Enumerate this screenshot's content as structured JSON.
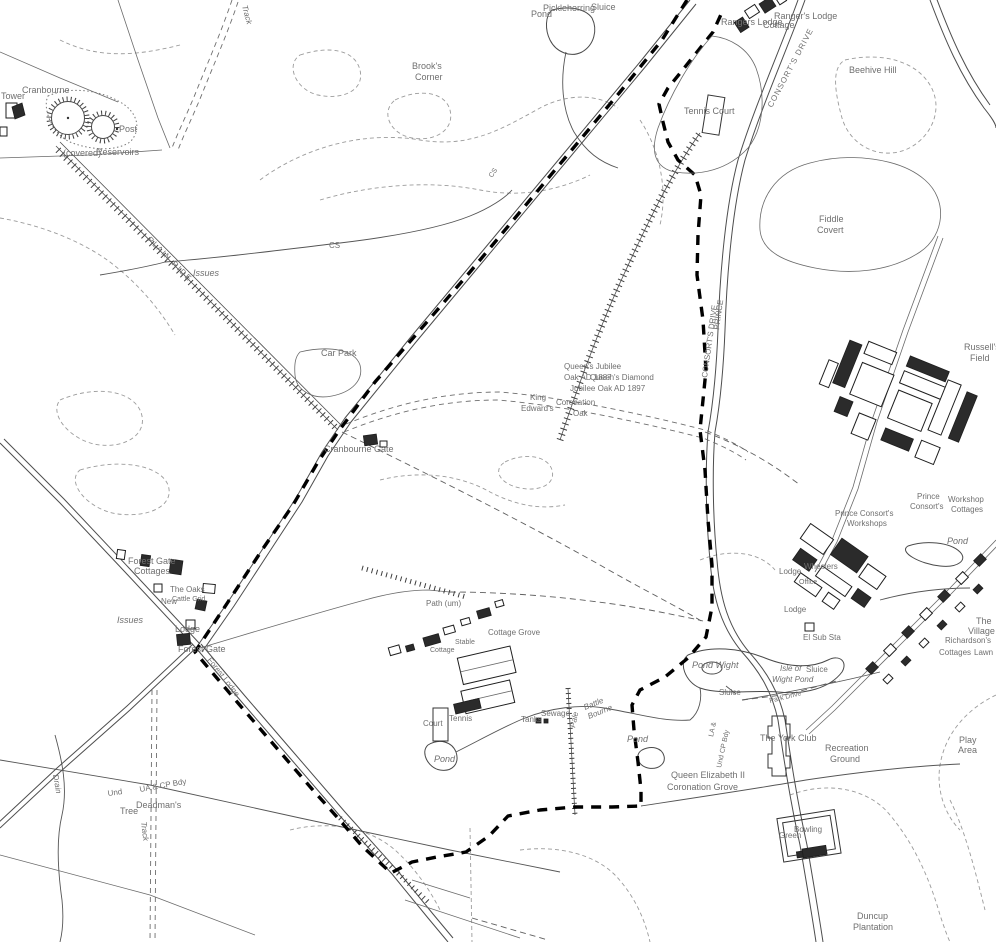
{
  "map": {
    "type": "ordnance-survey-style-topographic-map",
    "colors": {
      "background": "#ffffff",
      "line_ink": "#4d4d4d",
      "boundary_ink": "#000000",
      "label_ink": "#6f6f6f"
    },
    "labels": [
      {
        "t": "Tower",
        "x": 1,
        "y": 99,
        "s": 9
      },
      {
        "t": "Cranbourne",
        "x": 22,
        "y": 93,
        "s": 9
      },
      {
        "t": "Post",
        "x": 119,
        "y": 132,
        "s": 9
      },
      {
        "t": "(covered)",
        "x": 63,
        "y": 156,
        "s": 9
      },
      {
        "t": "Reservoirs",
        "x": 96,
        "y": 155,
        "s": 9
      },
      {
        "t": "PLAIN RIDE",
        "x": 147,
        "y": 240,
        "s": 8,
        "r": 45,
        "sp": 1.5
      },
      {
        "t": "Track",
        "x": 242,
        "y": 6,
        "s": 8,
        "r": 75,
        "i": 1
      },
      {
        "t": "Issues",
        "x": 193,
        "y": 276,
        "s": 9,
        "i": 1
      },
      {
        "t": "CS",
        "x": 329,
        "y": 248,
        "s": 8
      },
      {
        "t": "CS",
        "x": 492,
        "y": 178,
        "s": 7,
        "r": -55
      },
      {
        "t": "Brook's",
        "x": 412,
        "y": 69,
        "s": 9
      },
      {
        "t": "Corner",
        "x": 415,
        "y": 80,
        "s": 9
      },
      {
        "t": "Pickleherring",
        "x": 543,
        "y": 11,
        "s": 9
      },
      {
        "t": "Pond",
        "x": 531,
        "y": 17,
        "s": 9
      },
      {
        "t": "Sluice",
        "x": 591,
        "y": 10,
        "s": 9
      },
      {
        "t": "Rangers Lodge",
        "x": 721,
        "y": 25,
        "s": 9
      },
      {
        "t": "Ranger's Lodge",
        "x": 774,
        "y": 19,
        "s": 9
      },
      {
        "t": "Cottage",
        "x": 763,
        "y": 28,
        "s": 9
      },
      {
        "t": "CONSORT'S DRIVE",
        "x": 772,
        "y": 108,
        "s": 8,
        "r": -62,
        "sp": 1
      },
      {
        "t": "Tennis Court",
        "x": 684,
        "y": 114,
        "s": 9
      },
      {
        "t": "Beehive Hill",
        "x": 849,
        "y": 73,
        "s": 9
      },
      {
        "t": "Fiddle",
        "x": 819,
        "y": 222,
        "s": 9
      },
      {
        "t": "Covert",
        "x": 817,
        "y": 233,
        "s": 9
      },
      {
        "t": "Russell's",
        "x": 964,
        "y": 350,
        "s": 9
      },
      {
        "t": "Field",
        "x": 970,
        "y": 361,
        "s": 9
      },
      {
        "t": "PRINCE",
        "x": 719,
        "y": 330,
        "s": 8,
        "r": -82
      },
      {
        "t": "CONSORT'S DRIVE",
        "x": 707,
        "y": 378,
        "s": 8,
        "r": -82
      },
      {
        "t": "Queen's Jubilee",
        "x": 564,
        "y": 369,
        "s": 8
      },
      {
        "t": "Oak AD 1887",
        "x": 564,
        "y": 380,
        "s": 8
      },
      {
        "t": "Queen's Diamond",
        "x": 590,
        "y": 380,
        "s": 8
      },
      {
        "t": "Jubilee Oak AD 1897",
        "x": 570,
        "y": 391,
        "s": 8
      },
      {
        "t": "King",
        "x": 530,
        "y": 400,
        "s": 8
      },
      {
        "t": "Edward's",
        "x": 521,
        "y": 411,
        "s": 8
      },
      {
        "t": "Coronation",
        "x": 556,
        "y": 405,
        "s": 8
      },
      {
        "t": "Oak",
        "x": 573,
        "y": 416,
        "s": 8
      },
      {
        "t": "Car Park",
        "x": 321,
        "y": 356,
        "s": 9
      },
      {
        "t": "Cranbourne Gate",
        "x": 324,
        "y": 452,
        "s": 9
      },
      {
        "t": "Forest Gate",
        "x": 128,
        "y": 564,
        "s": 9
      },
      {
        "t": "Cottages",
        "x": 134,
        "y": 574,
        "s": 9
      },
      {
        "t": "The Oaks",
        "x": 170,
        "y": 592,
        "s": 8
      },
      {
        "t": "Cattle Grid",
        "x": 172,
        "y": 601,
        "s": 7
      },
      {
        "t": "New",
        "x": 161,
        "y": 604,
        "s": 8
      },
      {
        "t": "Lodge",
        "x": 175,
        "y": 632,
        "s": 9
      },
      {
        "t": "Forest Gate",
        "x": 178,
        "y": 652,
        "s": 9
      },
      {
        "t": "Forest Lodge",
        "x": 207,
        "y": 660,
        "s": 8,
        "r": 52
      },
      {
        "t": "Issues",
        "x": 117,
        "y": 623,
        "s": 9,
        "i": 1
      },
      {
        "t": "Drain",
        "x": 53,
        "y": 775,
        "s": 8,
        "r": 80,
        "i": 1
      },
      {
        "t": "Und",
        "x": 108,
        "y": 796,
        "s": 8,
        "r": -8
      },
      {
        "t": "UA & CP Bdy",
        "x": 140,
        "y": 792,
        "s": 8,
        "r": -10
      },
      {
        "t": "Deadman's",
        "x": 136,
        "y": 808,
        "s": 9
      },
      {
        "t": "Tree",
        "x": 120,
        "y": 814,
        "s": 9
      },
      {
        "t": "Track",
        "x": 141,
        "y": 822,
        "s": 8,
        "r": 83,
        "i": 1
      },
      {
        "t": "Path (um)",
        "x": 426,
        "y": 606,
        "s": 8
      },
      {
        "t": "Cottage Grove",
        "x": 488,
        "y": 635,
        "s": 8
      },
      {
        "t": "Stable",
        "x": 455,
        "y": 644,
        "s": 7
      },
      {
        "t": "Cottage",
        "x": 430,
        "y": 652,
        "s": 7
      },
      {
        "t": "Court",
        "x": 423,
        "y": 726,
        "s": 8
      },
      {
        "t": "Tennis",
        "x": 449,
        "y": 721,
        "s": 8
      },
      {
        "t": "Pond",
        "x": 434,
        "y": 762,
        "s": 9,
        "i": 1
      },
      {
        "t": "Tanks",
        "x": 521,
        "y": 722,
        "s": 8
      },
      {
        "t": "Sewage",
        "x": 541,
        "y": 716,
        "s": 8
      },
      {
        "t": "Pale",
        "x": 575,
        "y": 728,
        "s": 8,
        "r": -78,
        "i": 1
      },
      {
        "t": "Battle",
        "x": 585,
        "y": 710,
        "s": 8,
        "r": -22,
        "i": 1
      },
      {
        "t": "Bourne",
        "x": 589,
        "y": 719,
        "s": 8,
        "r": -22,
        "i": 1
      },
      {
        "t": "Pond",
        "x": 627,
        "y": 742,
        "s": 9,
        "i": 1
      },
      {
        "t": "Pond Wight",
        "x": 692,
        "y": 668,
        "s": 9,
        "i": 1
      },
      {
        "t": "Sluice",
        "x": 719,
        "y": 695,
        "s": 8
      },
      {
        "t": "Isle of",
        "x": 780,
        "y": 671,
        "s": 8,
        "i": 1
      },
      {
        "t": "Wight Pond",
        "x": 772,
        "y": 682,
        "s": 8,
        "i": 1
      },
      {
        "t": "Sluice",
        "x": 806,
        "y": 672,
        "s": 8
      },
      {
        "t": "Pond",
        "x": 947,
        "y": 544,
        "s": 9,
        "i": 1
      },
      {
        "t": "Lodge",
        "x": 779,
        "y": 574,
        "s": 8
      },
      {
        "t": "Wheelers",
        "x": 804,
        "y": 569,
        "s": 8
      },
      {
        "t": "Office",
        "x": 799,
        "y": 584,
        "s": 7
      },
      {
        "t": "Lodge",
        "x": 784,
        "y": 612,
        "s": 8
      },
      {
        "t": "El Sub Sta",
        "x": 803,
        "y": 640,
        "s": 8
      },
      {
        "t": "The",
        "x": 976,
        "y": 624,
        "s": 9
      },
      {
        "t": "Village",
        "x": 968,
        "y": 634,
        "s": 9
      },
      {
        "t": "Richardson's",
        "x": 945,
        "y": 643,
        "s": 8
      },
      {
        "t": "Cottages",
        "x": 939,
        "y": 655,
        "s": 8
      },
      {
        "t": "Lawn",
        "x": 974,
        "y": 655,
        "s": 8
      },
      {
        "t": "Prince",
        "x": 917,
        "y": 499,
        "s": 8
      },
      {
        "t": "Consort's",
        "x": 910,
        "y": 509,
        "s": 8
      },
      {
        "t": "Workshop",
        "x": 948,
        "y": 502,
        "s": 8
      },
      {
        "t": "Cottages",
        "x": 951,
        "y": 512,
        "s": 8
      },
      {
        "t": "Prince Consort's",
        "x": 835,
        "y": 516,
        "s": 8
      },
      {
        "t": "Workshops",
        "x": 847,
        "y": 526,
        "s": 8
      },
      {
        "t": "The York Club",
        "x": 760,
        "y": 741,
        "s": 9
      },
      {
        "t": "Recreation",
        "x": 825,
        "y": 751,
        "s": 9
      },
      {
        "t": "Ground",
        "x": 830,
        "y": 762,
        "s": 9
      },
      {
        "t": "Queen Elizabeth II",
        "x": 671,
        "y": 778,
        "s": 9
      },
      {
        "t": "Coronation Grove",
        "x": 667,
        "y": 790,
        "s": 9
      },
      {
        "t": "Play",
        "x": 959,
        "y": 743,
        "s": 9
      },
      {
        "t": "Area",
        "x": 958,
        "y": 753,
        "s": 9
      },
      {
        "t": "Bowling",
        "x": 794,
        "y": 832,
        "s": 8
      },
      {
        "t": "Green",
        "x": 779,
        "y": 838,
        "s": 8
      },
      {
        "t": "Duncup",
        "x": 857,
        "y": 919,
        "s": 9
      },
      {
        "t": "Plantation",
        "x": 853,
        "y": 930,
        "s": 9
      },
      {
        "t": "LA &",
        "x": 713,
        "y": 737,
        "s": 7,
        "r": -78
      },
      {
        "t": "Und CP Bdy",
        "x": 721,
        "y": 768,
        "s": 7,
        "r": -78
      },
      {
        "t": "Park Drive",
        "x": 770,
        "y": 703,
        "s": 7,
        "r": -14
      }
    ]
  }
}
